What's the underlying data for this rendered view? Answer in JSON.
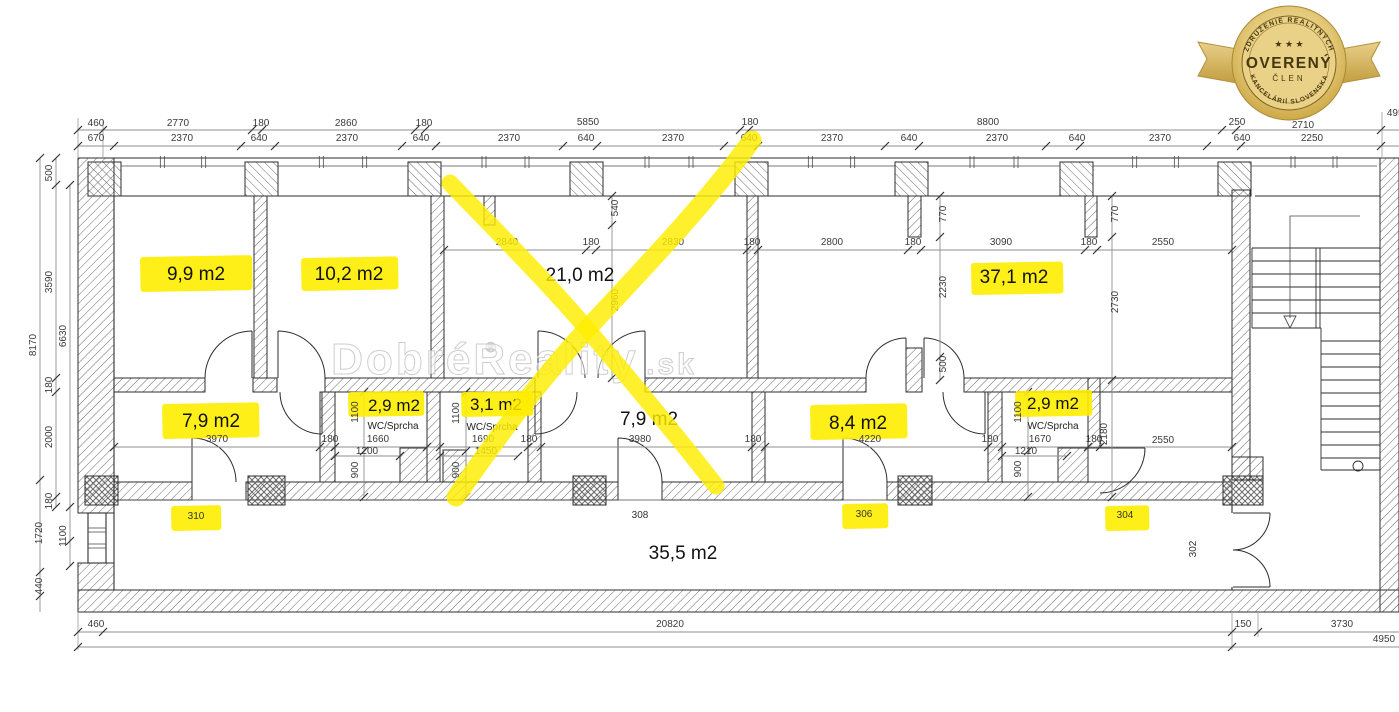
{
  "colors": {
    "highlight": "#ffed00",
    "badge_gold": "#d8b85a",
    "badge_text": "#45370f"
  },
  "badge": {
    "association": "ZDRUŽENIE REALITNÝCH",
    "stars": "★ ★ ★",
    "title": "OVERENÝ",
    "member": "ČLEN",
    "org": "KANCELÁRIÍ SLOVENSKA"
  },
  "watermark": {
    "symbol": "®",
    "name": "DobréReality",
    "tld": ".sk"
  },
  "plan": {
    "area_labels": [
      {
        "t": "9,9 m2",
        "x": 196,
        "y": 280,
        "hl": [
          140,
          257,
          112,
          35
        ]
      },
      {
        "t": "10,2 m2",
        "x": 349,
        "y": 280,
        "hl": [
          301,
          258,
          97,
          33
        ]
      },
      {
        "t": "21,0 m2",
        "x": 580,
        "y": 281
      },
      {
        "t": "37,1 m2",
        "x": 1014,
        "y": 283,
        "hl": [
          971,
          263,
          92,
          32
        ]
      },
      {
        "t": "7,9 m2",
        "x": 211,
        "y": 427,
        "hl": [
          162,
          404,
          97,
          35
        ]
      },
      {
        "t": "7,9 m2",
        "x": 649,
        "y": 425
      },
      {
        "t": "8,4 m2",
        "x": 858,
        "y": 429,
        "hl": [
          810,
          405,
          97,
          35
        ]
      },
      {
        "t": "35,5 m2",
        "x": 683,
        "y": 559
      }
    ],
    "wc_labels": [
      {
        "t": "2,9 m2",
        "x": 394,
        "y": 411,
        "hl": [
          348,
          392,
          76,
          25
        ]
      },
      {
        "t": "3,1 m2",
        "x": 496,
        "y": 410,
        "hl": [
          461,
          392,
          72,
          25
        ]
      },
      {
        "t": "2,9 m2",
        "x": 1053,
        "y": 409,
        "hl": [
          1015,
          391,
          77,
          26
        ]
      }
    ],
    "wc_sub_labels": [
      {
        "t": "WC/Sprcha",
        "x": 393,
        "y": 429
      },
      {
        "t": "WC/Sprcha",
        "x": 492,
        "y": 430
      },
      {
        "t": "WC/Sprcha",
        "x": 1053,
        "y": 429
      }
    ],
    "room_numbers": [
      {
        "t": "310",
        "x": 196,
        "y": 519,
        "hl": [
          171,
          506,
          50,
          25
        ]
      },
      {
        "t": "308",
        "x": 640,
        "y": 518
      },
      {
        "t": "306",
        "x": 864,
        "y": 517,
        "hl": [
          842,
          504,
          46,
          25
        ]
      },
      {
        "t": "304",
        "x": 1125,
        "y": 518,
        "hl": [
          1105,
          506,
          44,
          25
        ]
      },
      {
        "t": "302",
        "x": 1196,
        "y": 549,
        "r": true
      }
    ],
    "dim_labels": [
      {
        "t": "460",
        "x": 96,
        "y": 126
      },
      {
        "t": "2770",
        "x": 178,
        "y": 126
      },
      {
        "t": "180",
        "x": 261,
        "y": 126
      },
      {
        "t": "2860",
        "x": 346,
        "y": 126
      },
      {
        "t": "180",
        "x": 424,
        "y": 126
      },
      {
        "t": "5850",
        "x": 588,
        "y": 125
      },
      {
        "t": "180",
        "x": 750,
        "y": 125
      },
      {
        "t": "8800",
        "x": 988,
        "y": 125
      },
      {
        "t": "250",
        "x": 1237,
        "y": 125
      },
      {
        "t": "2710",
        "x": 1303,
        "y": 128
      },
      {
        "t": "4950",
        "x": 1398,
        "y": 116
      },
      {
        "t": "670",
        "x": 96,
        "y": 141
      },
      {
        "t": "2370",
        "x": 182,
        "y": 141
      },
      {
        "t": "640",
        "x": 259,
        "y": 141
      },
      {
        "t": "2370",
        "x": 347,
        "y": 141
      },
      {
        "t": "640",
        "x": 421,
        "y": 141
      },
      {
        "t": "2370",
        "x": 509,
        "y": 141
      },
      {
        "t": "640",
        "x": 586,
        "y": 141
      },
      {
        "t": "2370",
        "x": 673,
        "y": 141
      },
      {
        "t": "640",
        "x": 749,
        "y": 141
      },
      {
        "t": "2370",
        "x": 832,
        "y": 141
      },
      {
        "t": "640",
        "x": 909,
        "y": 141
      },
      {
        "t": "2370",
        "x": 997,
        "y": 141
      },
      {
        "t": "640",
        "x": 1077,
        "y": 141
      },
      {
        "t": "2370",
        "x": 1160,
        "y": 141
      },
      {
        "t": "640",
        "x": 1242,
        "y": 141
      },
      {
        "t": "2250",
        "x": 1312,
        "y": 141
      },
      {
        "t": "2840",
        "x": 507,
        "y": 245
      },
      {
        "t": "180",
        "x": 591,
        "y": 245
      },
      {
        "t": "2830",
        "x": 673,
        "y": 245
      },
      {
        "t": "180",
        "x": 752,
        "y": 245
      },
      {
        "t": "2800",
        "x": 832,
        "y": 245
      },
      {
        "t": "180",
        "x": 913,
        "y": 245
      },
      {
        "t": "3090",
        "x": 1001,
        "y": 245
      },
      {
        "t": "180",
        "x": 1089,
        "y": 245
      },
      {
        "t": "2550",
        "x": 1163,
        "y": 245
      },
      {
        "t": "540",
        "x": 618,
        "y": 208,
        "r": true
      },
      {
        "t": "2960",
        "x": 618,
        "y": 300,
        "r": true
      },
      {
        "t": "770",
        "x": 946,
        "y": 214,
        "r": true
      },
      {
        "t": "2230",
        "x": 946,
        "y": 287,
        "r": true
      },
      {
        "t": "500",
        "x": 946,
        "y": 364,
        "r": true
      },
      {
        "t": "770",
        "x": 1118,
        "y": 214,
        "r": true
      },
      {
        "t": "2730",
        "x": 1118,
        "y": 302,
        "r": true
      },
      {
        "t": "2180",
        "x": 1107,
        "y": 434,
        "r": true
      },
      {
        "t": "3970",
        "x": 217,
        "y": 442
      },
      {
        "t": "180",
        "x": 330,
        "y": 442
      },
      {
        "t": "1660",
        "x": 378,
        "y": 442
      },
      {
        "t": "1690",
        "x": 483,
        "y": 442
      },
      {
        "t": "180",
        "x": 529,
        "y": 442
      },
      {
        "t": "3980",
        "x": 640,
        "y": 442
      },
      {
        "t": "180",
        "x": 753,
        "y": 442
      },
      {
        "t": "4220",
        "x": 870,
        "y": 442
      },
      {
        "t": "180",
        "x": 990,
        "y": 442
      },
      {
        "t": "1670",
        "x": 1040,
        "y": 442
      },
      {
        "t": "180",
        "x": 1094,
        "y": 442
      },
      {
        "t": "2550",
        "x": 1163,
        "y": 443
      },
      {
        "t": "1200",
        "x": 367,
        "y": 454
      },
      {
        "t": "1450",
        "x": 486,
        "y": 454
      },
      {
        "t": "1210",
        "x": 1026,
        "y": 454
      },
      {
        "t": "1100",
        "x": 358,
        "y": 412,
        "r": true
      },
      {
        "t": "900",
        "x": 358,
        "y": 470,
        "r": true
      },
      {
        "t": "1100",
        "x": 459,
        "y": 413,
        "r": true
      },
      {
        "t": "900",
        "x": 459,
        "y": 470,
        "r": true
      },
      {
        "t": "1100",
        "x": 1021,
        "y": 412,
        "r": true
      },
      {
        "t": "900",
        "x": 1021,
        "y": 469,
        "r": true
      },
      {
        "t": "8170",
        "x": 36,
        "y": 345,
        "r": true
      },
      {
        "t": "500",
        "x": 52,
        "y": 173,
        "r": true
      },
      {
        "t": "3590",
        "x": 52,
        "y": 282,
        "r": true
      },
      {
        "t": "180",
        "x": 52,
        "y": 385,
        "r": true
      },
      {
        "t": "2000",
        "x": 52,
        "y": 437,
        "r": true
      },
      {
        "t": "180",
        "x": 52,
        "y": 501,
        "r": true
      },
      {
        "t": "6630",
        "x": 66,
        "y": 336,
        "r": true
      },
      {
        "t": "1100",
        "x": 66,
        "y": 536,
        "r": true
      },
      {
        "t": "1720",
        "x": 42,
        "y": 533,
        "r": true
      },
      {
        "t": "440",
        "x": 42,
        "y": 586,
        "r": true
      },
      {
        "t": "460",
        "x": 96,
        "y": 627
      },
      {
        "t": "20820",
        "x": 670,
        "y": 627
      },
      {
        "t": "150",
        "x": 1243,
        "y": 627
      },
      {
        "t": "3730",
        "x": 1342,
        "y": 627
      },
      {
        "t": "4950",
        "x": 1384,
        "y": 642
      }
    ]
  }
}
